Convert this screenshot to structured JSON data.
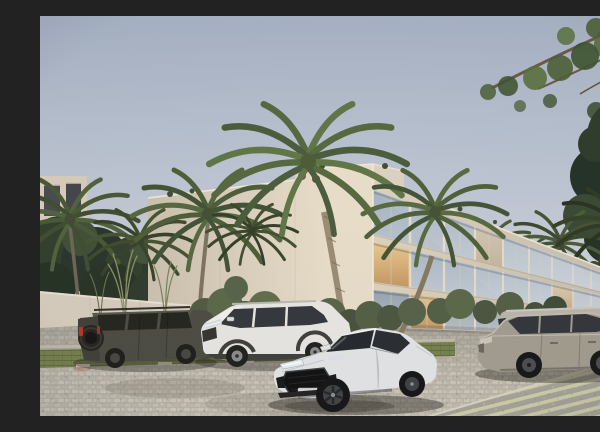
{
  "scene": {
    "type": "architectural-exterior-render",
    "description": "Dusk 3D rendering of a modern three-story cream apartment building with floor-to-ceiling glass windows, coconut palms and tropical shrubs, five vehicles parked along a cobblestone street with grass-paver parking strips",
    "setting": "tropical residential street",
    "time_of_day": "dusk",
    "building": {
      "label": "three-story modern apartment building",
      "floors_visible": 3,
      "window_bays_visible": 10,
      "lit_windows": true
    },
    "vehicles": [
      {
        "label": "dark olive off-road SUV with rear-mounted spare tire",
        "position": "far left, parked"
      },
      {
        "label": "white compact crossover SUV",
        "position": "left, parked"
      },
      {
        "label": "white sports coupe with black honeycomb grille",
        "position": "center foreground"
      },
      {
        "label": "light gray boxy passenger van",
        "position": "right, parked behind sedan"
      },
      {
        "label": "warm gray luxury sedan",
        "position": "right foreground, parked"
      }
    ],
    "vegetation": [
      "coconut palms",
      "tropical shrubs",
      "tall ornamental grasses",
      "overhanging tree branch"
    ],
    "ground": "cobblestone paving with grass-paver parking strips and striped pavers"
  },
  "palette": {
    "sky_top": "#a6b2c6",
    "sky_horizon": "#e0ddd5",
    "building_end_wall": "#e8decb",
    "building_facade": "#ddd3c0",
    "building_wing": "#d9cfbd",
    "glass_cool": "#b3c0cd",
    "glass_warm": "#e3b878",
    "palm_green": "#55683f",
    "foliage_dark": "#2e3b2c",
    "stone_wall": "#b2a083",
    "white_wall": "#eae4d8",
    "left_wall": "#d7cebf",
    "road": "#c6c1b6",
    "grass_paver": "#75804d",
    "suv_dark": "#4b4b43",
    "suv_white": "#e8e8e5",
    "coupe_white": "#e4e6e8",
    "van_gray": "#b9b6ae",
    "sedan_gray": "#a29c90"
  }
}
